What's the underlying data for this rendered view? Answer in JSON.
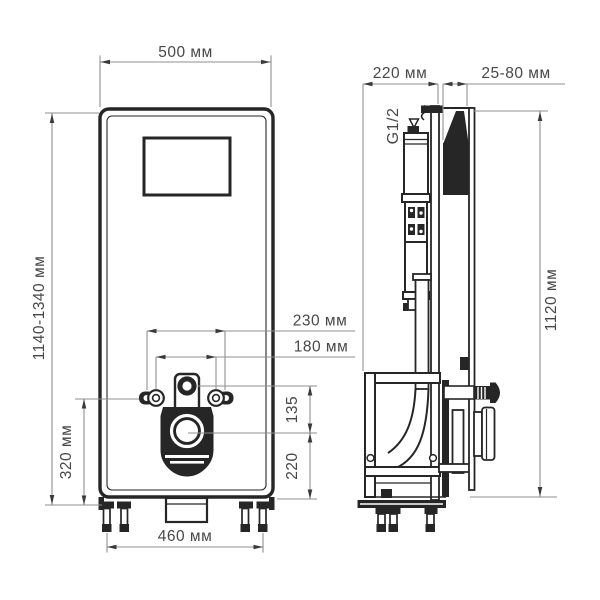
{
  "drawing": {
    "title": "WC installation module technical drawing",
    "front_view": {
      "dim_width": "500 мм",
      "dim_height_range": "1140-1340 мм",
      "dim_fixing_outer": "230 мм",
      "dim_fixing_inner": "180 мм",
      "dim_inlet_to_outlet": "135",
      "dim_outlet_height": "220",
      "dim_fixing_height": "320 мм",
      "dim_base_width": "460 мм"
    },
    "side_view": {
      "dim_depth": "220 мм",
      "dim_wall_offset": "25-80 мм",
      "dim_height": "1120 мм",
      "label_water_inlet": "G1/2"
    },
    "colors": {
      "ink": "#262626",
      "dim_line": "#8f8f8f",
      "text": "#474747",
      "background": "#ffffff"
    }
  }
}
